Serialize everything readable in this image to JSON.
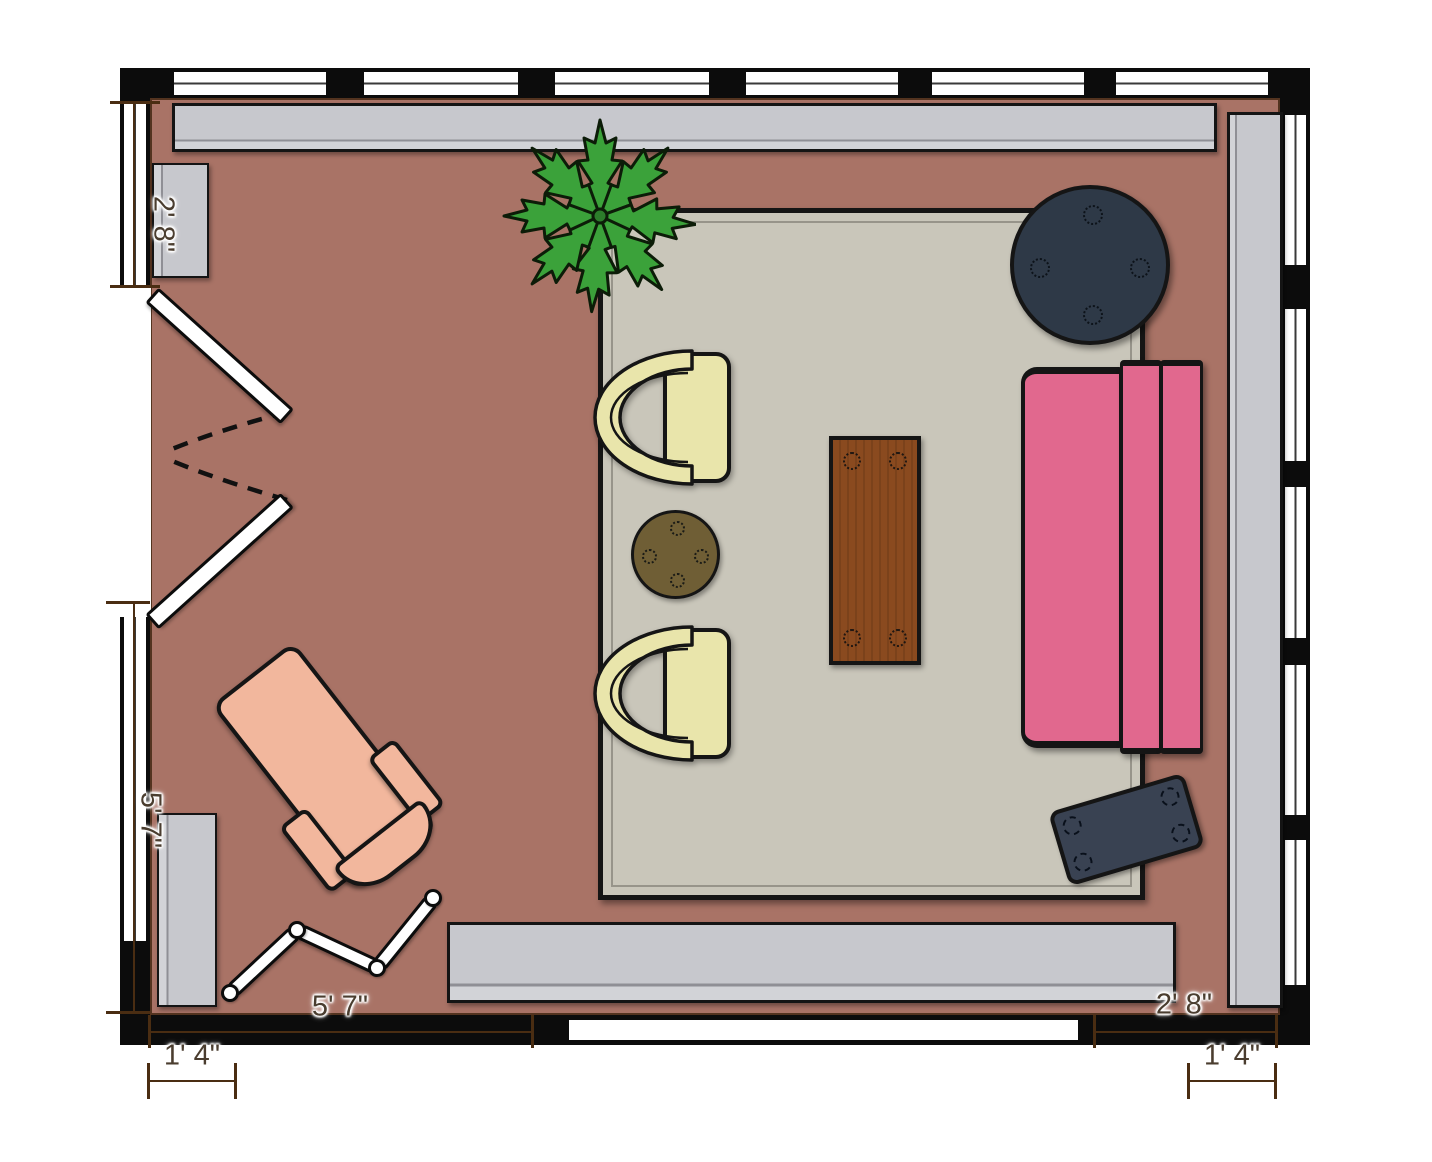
{
  "title": "Living room floor plan",
  "dims": {
    "left_window_top": "2' 8\"",
    "left_window_bottom": "5' 7\"",
    "bottom_wall_left": "5' 7\"",
    "bottom_offset_left": "1' 4\"",
    "bottom_wall_right": "2' 8\"",
    "bottom_offset_right": "1' 4\""
  },
  "colors": {
    "wall": "#0c0c0c",
    "floor": "#a97366",
    "floor_trim": "#53331f",
    "window": "#ffffff",
    "rug": "#c9c6ba",
    "console_gray": "#c7c8cd",
    "armchair_cream": "#e9e5ab",
    "side_table_brown": "#6f5e35",
    "coffee_table_wood": "#8a4a1f",
    "round_table_navy": "#2e3947",
    "ottoman_slate": "#394252",
    "sofa_pink": "#e1688e",
    "chaise_peach": "#f2b79d",
    "plant_green": "#3ba23a",
    "dimension_text": "#4a3d2f",
    "dimension_line": "#4a2d12"
  },
  "furniture": [
    "top-sideboard",
    "right-sideboard",
    "bottom-sideboard",
    "left-cabinet-upper",
    "left-cabinet-lower",
    "area-rug",
    "tub-armchair-upper",
    "tub-armchair-lower",
    "round-side-table",
    "coffee-table",
    "round-table",
    "pink-sofa",
    "ottoman-tray",
    "chaise-lounge",
    "folding-screen",
    "potted-plant",
    "double-door"
  ]
}
